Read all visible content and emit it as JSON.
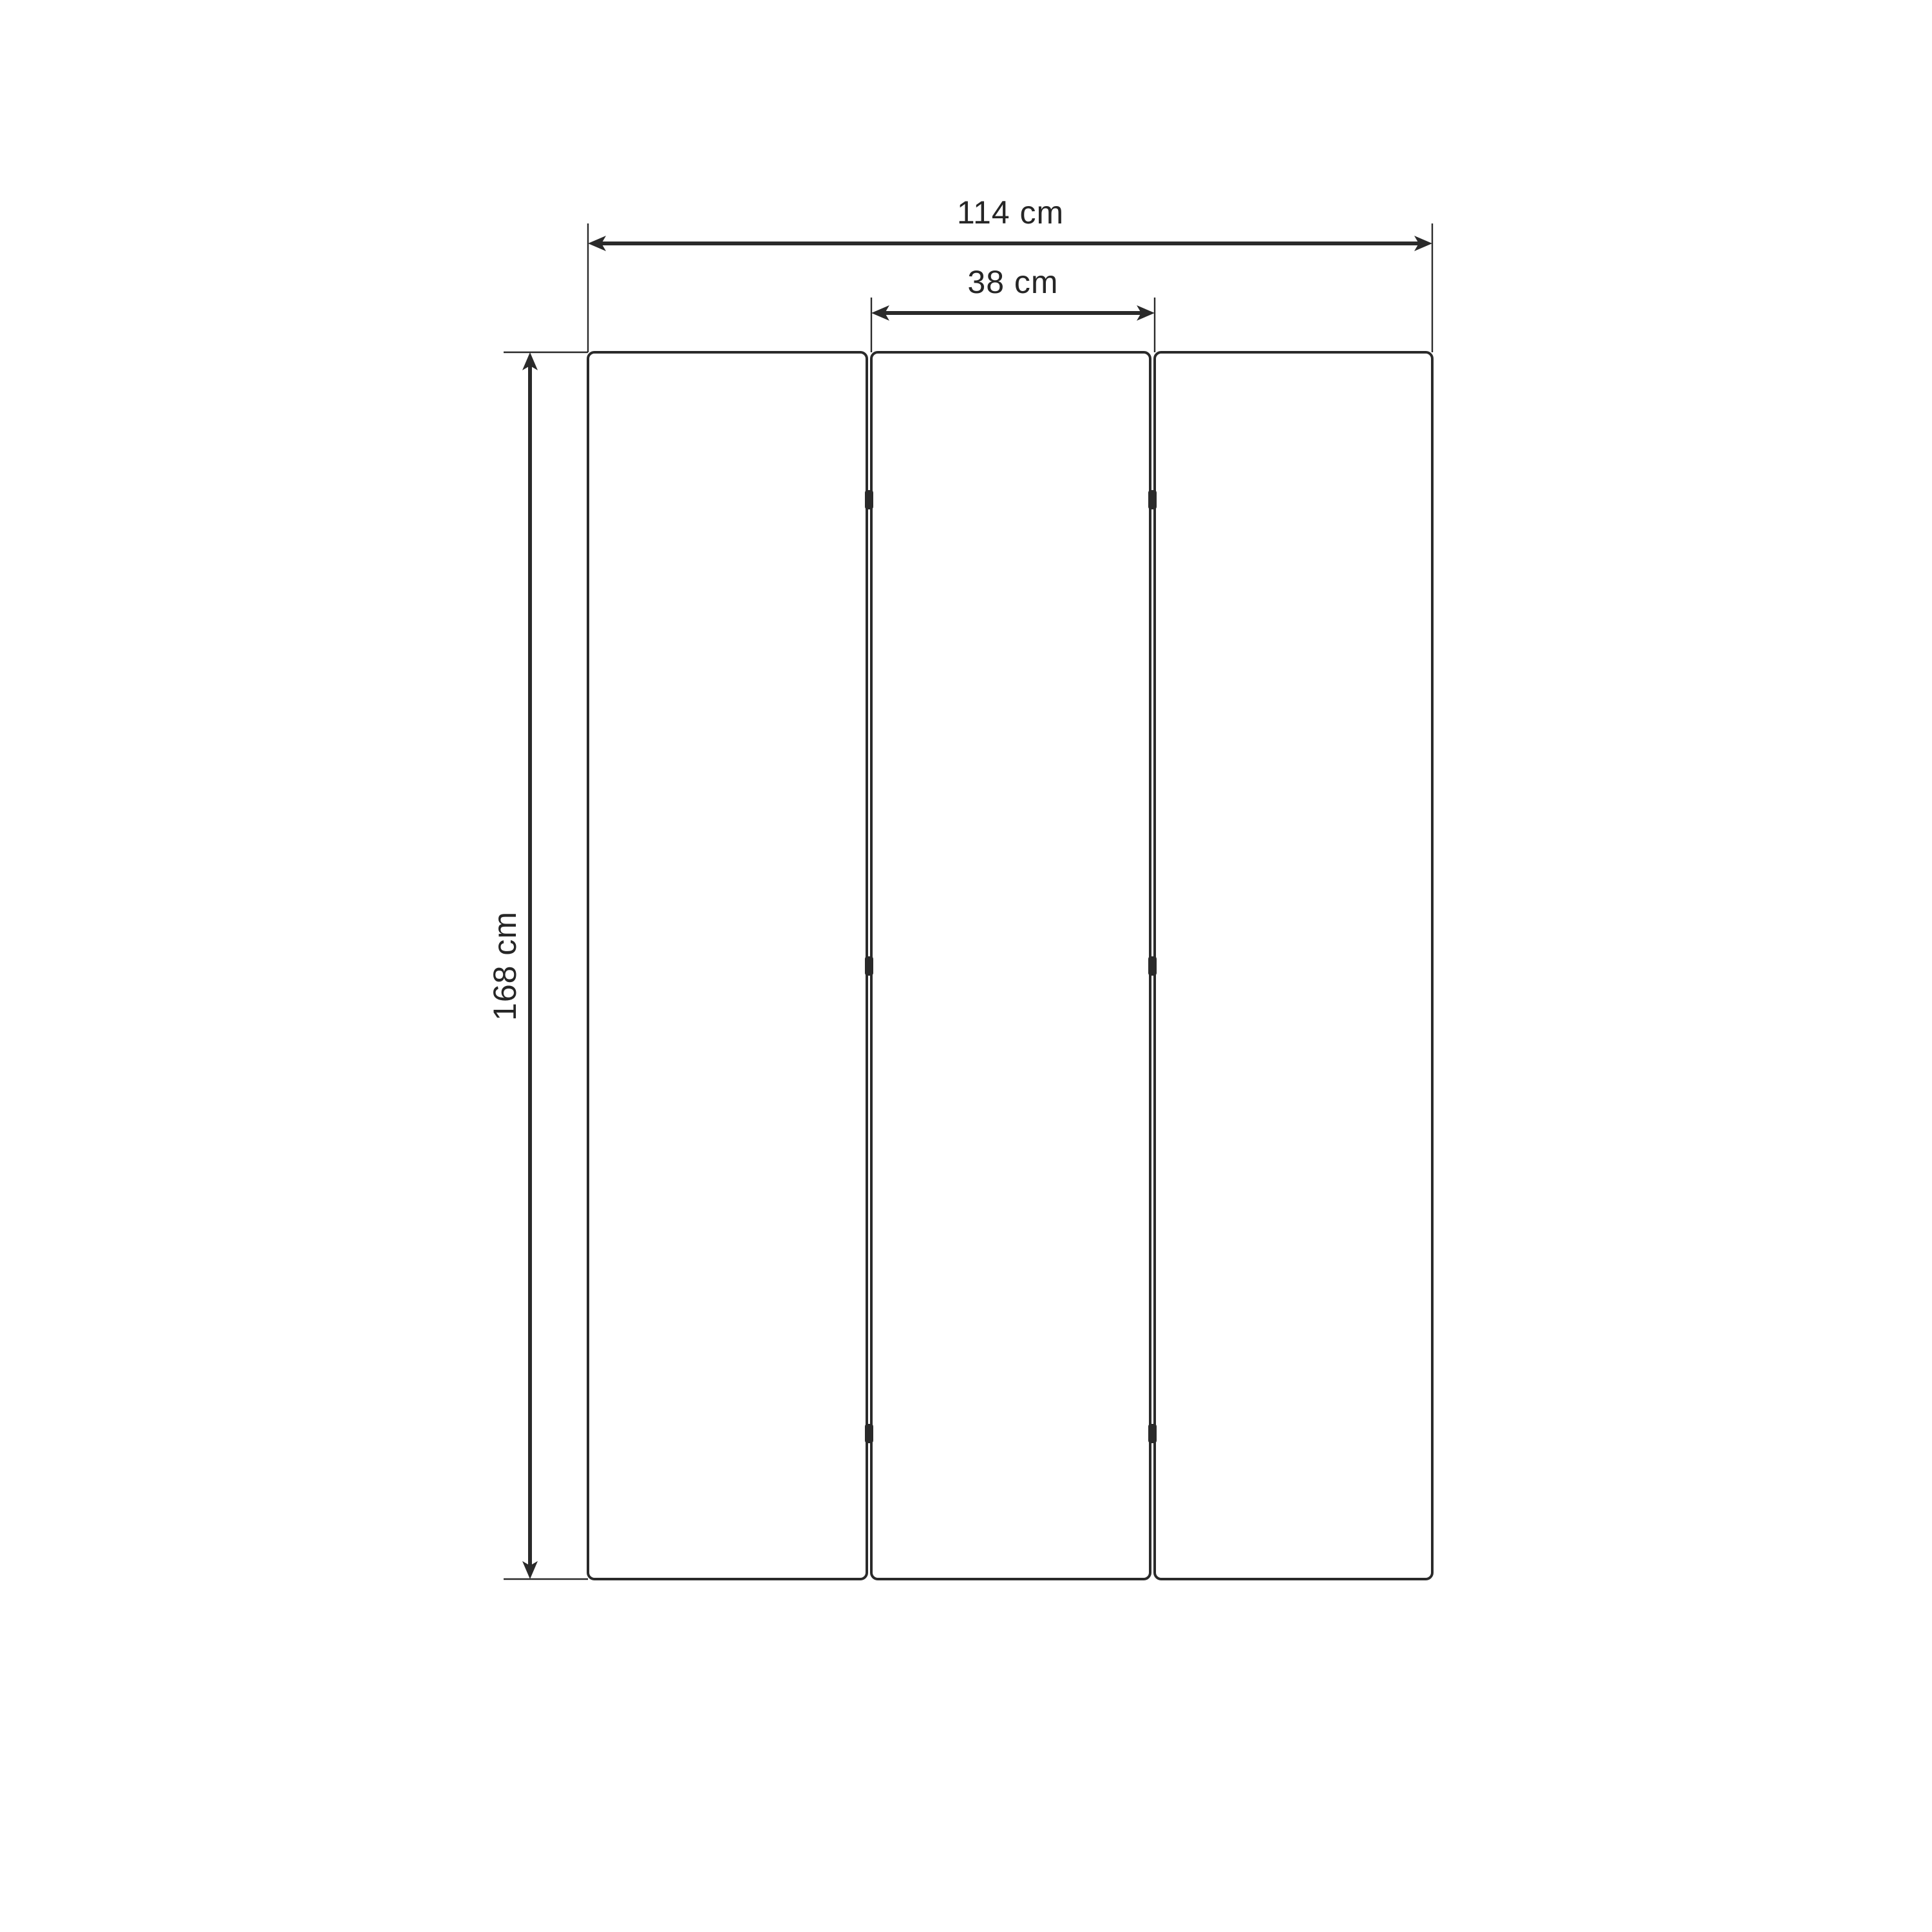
{
  "drawing": {
    "unit": "cm",
    "colors": {
      "stroke": "#2a2a2a",
      "text": "#262626",
      "background": "#ffffff"
    },
    "panels": {
      "count": 3,
      "panel_width_cm": 38,
      "total_width_cm": 114,
      "height_cm": 168
    },
    "hinge_count": 6,
    "dimensions": {
      "total_width": {
        "label": "114 cm",
        "value_cm": 114,
        "orientation": "horizontal"
      },
      "panel_width": {
        "label": "38 cm",
        "value_cm": 38,
        "orientation": "horizontal"
      },
      "height": {
        "label": "168 cm",
        "value_cm": 168,
        "orientation": "vertical"
      }
    }
  }
}
